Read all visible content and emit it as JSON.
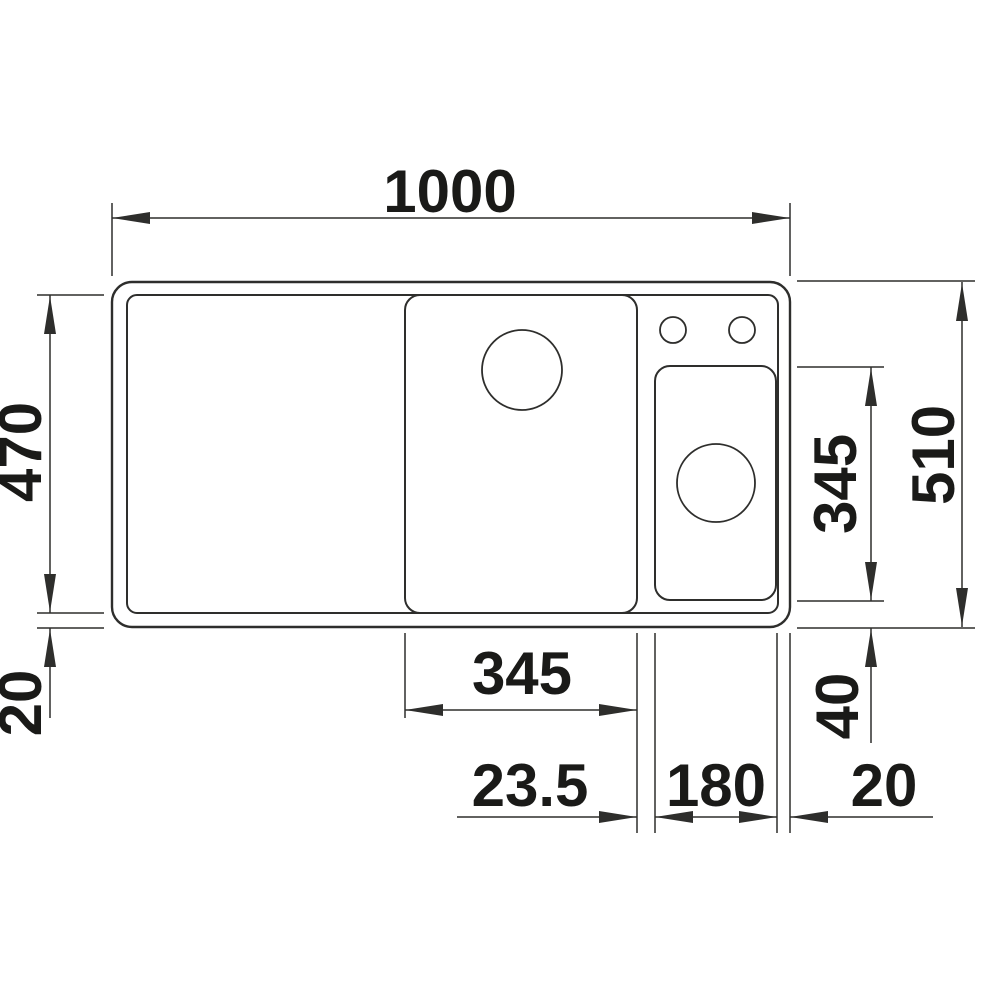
{
  "drawing": {
    "title": "sink-dimension-drawing",
    "view": "top",
    "unit": "mm",
    "colors": {
      "line": "#2e2e2c",
      "text": "#1a1a18",
      "background": "#ffffff"
    },
    "dimensions": {
      "overall_width": "1000",
      "overall_depth": "510",
      "bowl_area_depth": "470",
      "rim_bottom_left": "20",
      "main_bowl_width": "345",
      "partition_width": "23.5",
      "small_bowl_width": "180",
      "rim_right": "20",
      "small_bowl_depth": "345",
      "rim_bottom_right": "40"
    }
  }
}
